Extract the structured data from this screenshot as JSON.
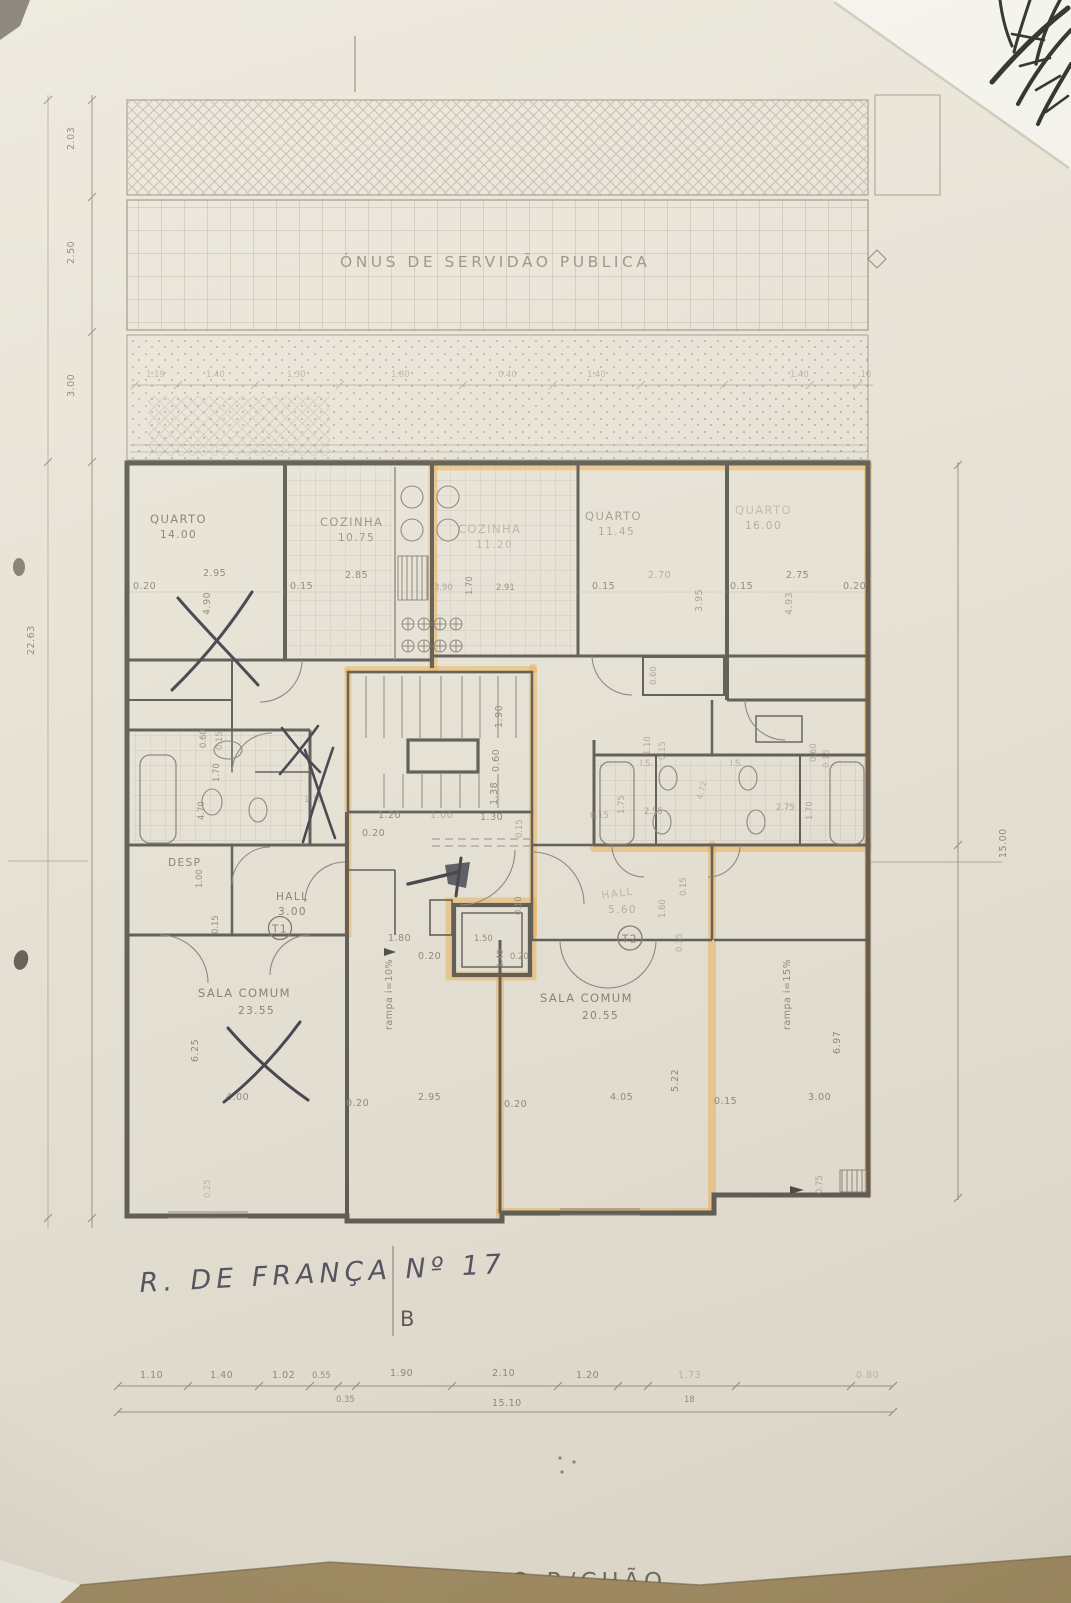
{
  "titles": {
    "plan_title": "PLANTA DO R/CHÃO",
    "servitude": "ÓNUS DE SERVIDÃO PUBLICA",
    "handwritten_address": "R. DE FRANÇA Nº 17",
    "section_letter": "B"
  },
  "rooms": {
    "quarto1": {
      "name": "QUARTO",
      "area": "14.00"
    },
    "cozinha1": {
      "name": "COZINHA",
      "area": "10.75"
    },
    "cozinha2": {
      "name": "COZINHA",
      "area": "11.20"
    },
    "quarto2": {
      "name": "QUARTO",
      "area": "11.45"
    },
    "quarto3": {
      "name": "QUARTO",
      "area": "16.00"
    },
    "sala1": {
      "name": "SALA COMUM",
      "area": "23.55"
    },
    "sala2": {
      "name": "SALA COMUM",
      "area": "20.55"
    },
    "hall1": {
      "name": "HALL",
      "area": "3.00"
    },
    "hall2": {
      "name": "HALL",
      "area": "5.60"
    },
    "desp": {
      "name": "DESP"
    },
    "is1": {
      "name": "I.S."
    },
    "is2": {
      "name": "I.S."
    }
  },
  "apartments": {
    "t1": "T1",
    "t2": "T2"
  },
  "ramps": {
    "ramp10": "rampa i=10%",
    "ramp15": "rampa i=15%"
  },
  "dims": {
    "left_col": [
      "2.03",
      "2.50",
      "3.00",
      "22.63"
    ],
    "right_total": "15.00",
    "top_row": [
      "1.19",
      "1.40",
      "1.30",
      "1.80",
      "0.40",
      "1.40",
      "1.40",
      ".10"
    ],
    "bottom_row": [
      "1.10",
      "1.40",
      "1.02",
      "0.55",
      "1.90",
      "2.10",
      "1.20",
      "1.73",
      "0.80"
    ],
    "bottom_sub": [
      "0.35",
      "18"
    ],
    "bottom_total": "15.10"
  },
  "plan_dims": {
    "d010": "0.10",
    "d015": "0.15",
    "d020": "0.20",
    "d025": "0.25",
    "d060": "0.60",
    "d075": "0.75",
    "d100": "1.00",
    "d110": "1.10",
    "d120": "1.20",
    "d130": "1.30",
    "d138": "1.38",
    "d140": "1.40",
    "d150": "1.50",
    "d160": "1.60",
    "d170": "1.70",
    "d175": "1.75",
    "d180": "1.80",
    "d190": "1.90",
    "d255": "2.55",
    "d270": "2.70",
    "d275": "2.75",
    "d285": "2.85",
    "d291": "2.91",
    "d295": "2.95",
    "d300": "3.00",
    "d390": "3.90",
    "d395": "3.95",
    "d400": "4.00",
    "d405": "4.05",
    "d470": "4.70",
    "d472": "4.72",
    "d490": "4.90",
    "d493": "4.93",
    "d522": "5.22",
    "d625": "6.25",
    "d697": "6.97"
  },
  "colors": {
    "highlight": "#f2b14e",
    "pen": "#3f3f4a",
    "walls": "#5c5953",
    "table": "#a08c63"
  }
}
